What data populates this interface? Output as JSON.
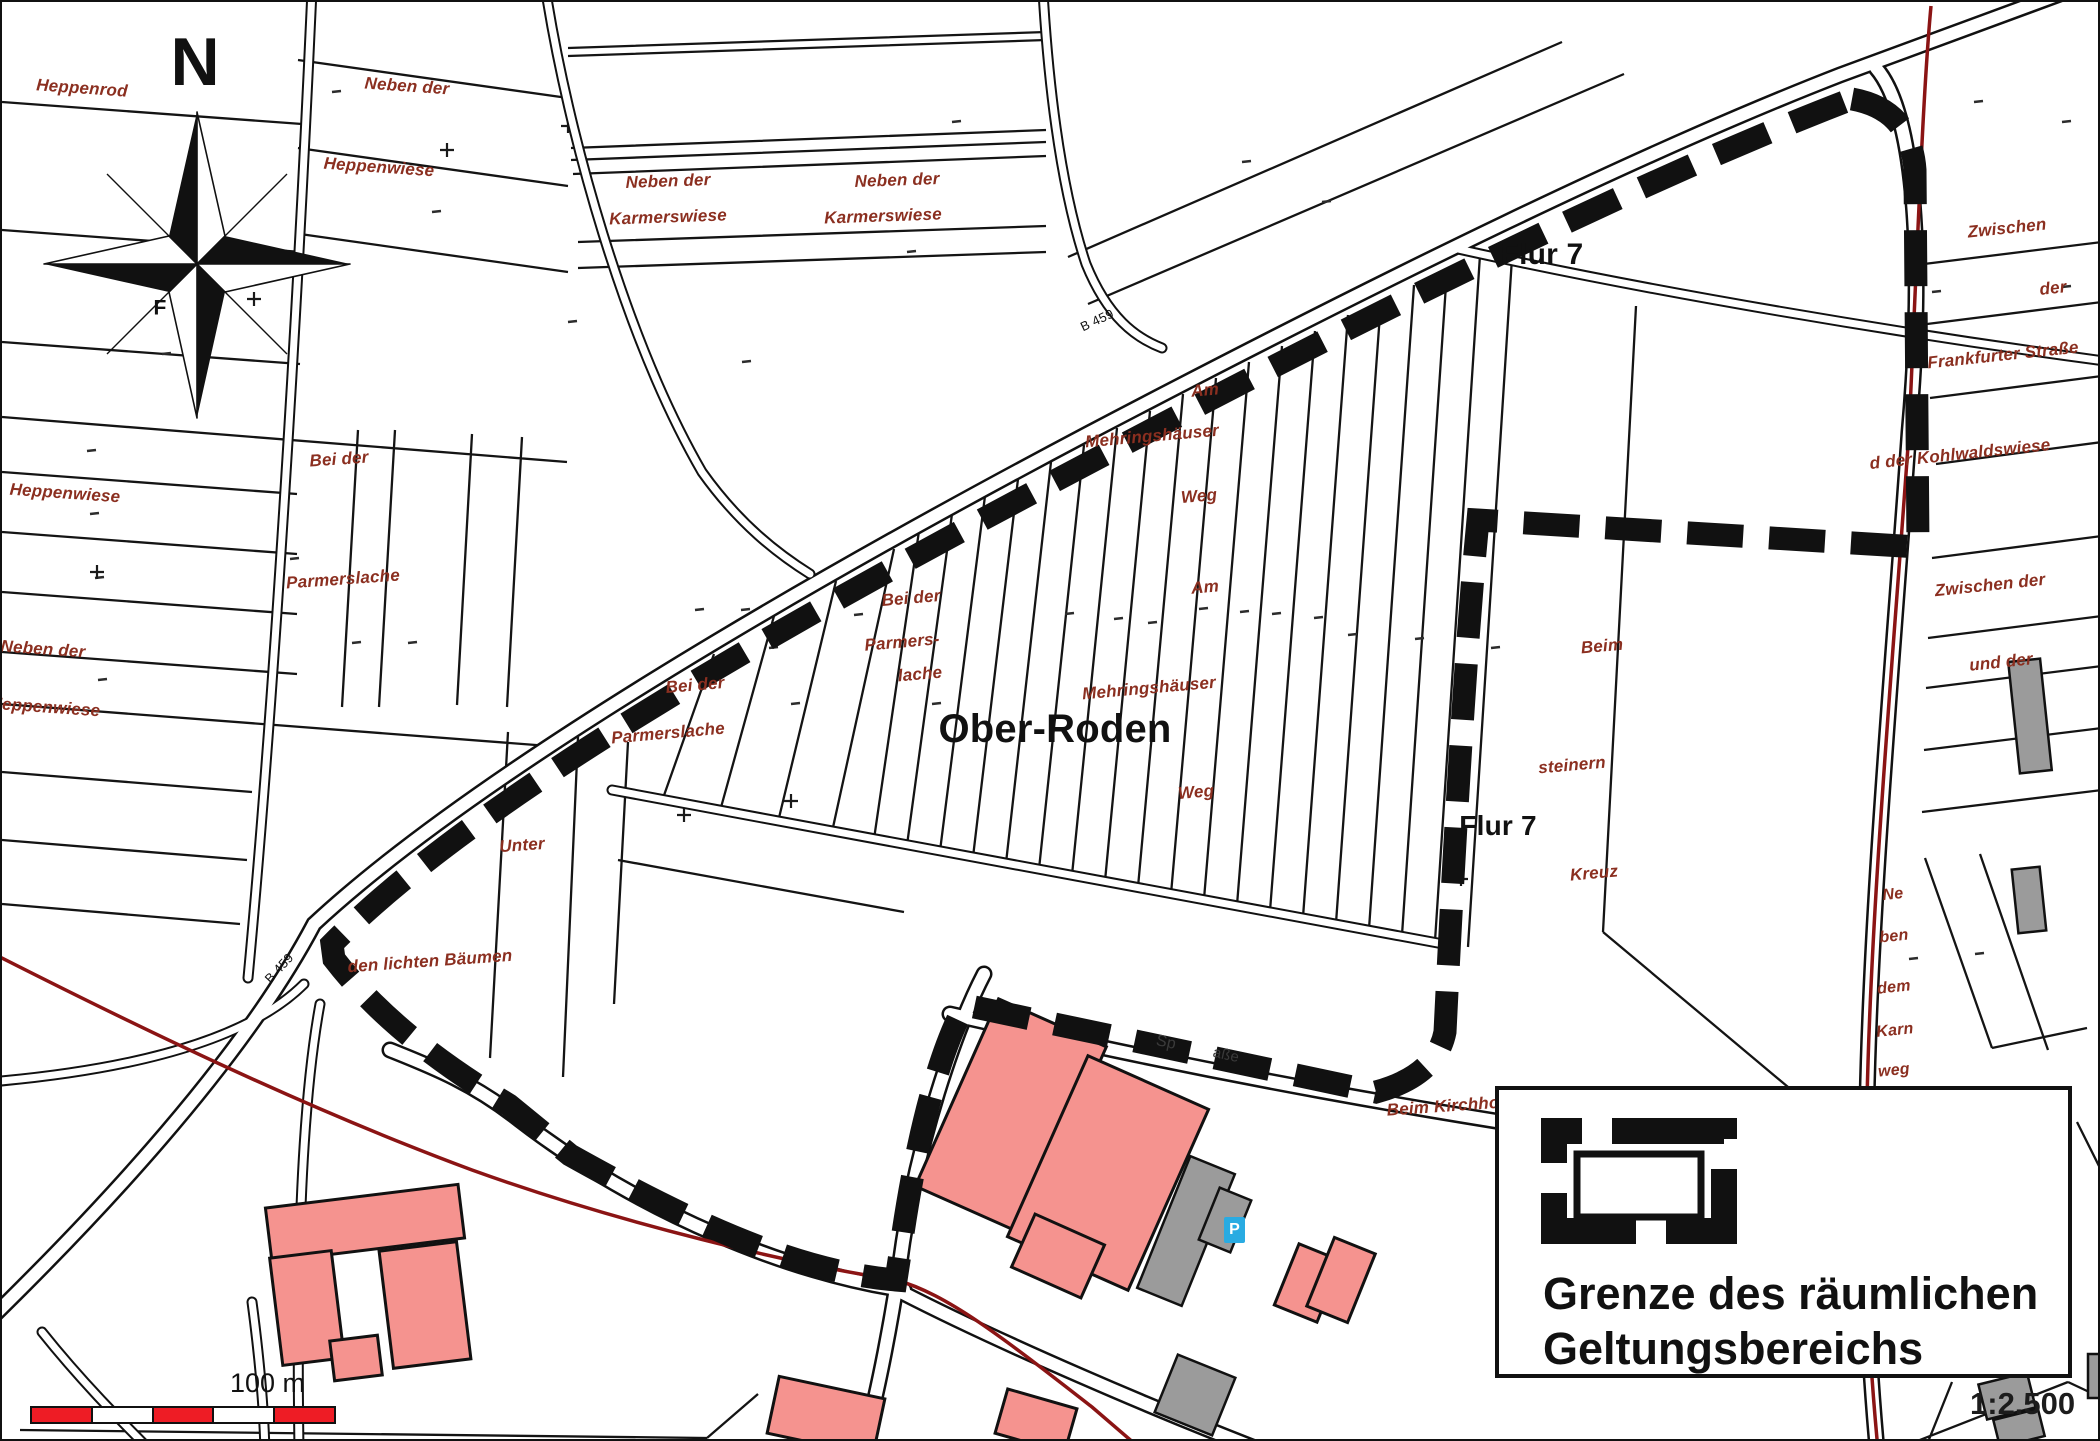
{
  "map": {
    "colors": {
      "field": "#8B2F20",
      "ink": "#111111",
      "ink2": "#3a3a3a",
      "building_pink": "#F5938F",
      "building_gray": "#9B9B9B",
      "parking_blue": "#29ABE2",
      "boundary_black": "#111111",
      "red_line": "#8B1414",
      "scalebar_red": "#EE1C25"
    },
    "compass": {
      "north_label": "N"
    },
    "legend": {
      "line1": "Grenze des räumlichen",
      "line2": "Geltungsbereichs"
    },
    "scale_bar": {
      "label": "100 m",
      "segments": [
        "#EE1C25",
        "#FFFFFF",
        "#EE1C25",
        "#FFFFFF",
        "#EE1C25"
      ]
    },
    "ratio_text": "1:2.500",
    "parking_label": "P",
    "labels": [
      {
        "t": "Heppenrod",
        "x": 80,
        "y": 86,
        "r": 4,
        "fs": 17,
        "c": "field",
        "b": 1,
        "i": 1
      },
      {
        "t": "Neben der",
        "x": 405,
        "y": 84,
        "r": 4,
        "fs": 17,
        "c": "field",
        "b": 1,
        "i": 1
      },
      {
        "t": "Heppenwiese",
        "x": 377,
        "y": 165,
        "r": 4,
        "fs": 17,
        "c": "field",
        "b": 1,
        "i": 1
      },
      {
        "t": "Neben der",
        "x": 666,
        "y": 179,
        "r": -2,
        "fs": 17,
        "c": "field",
        "b": 1,
        "i": 1
      },
      {
        "t": "Karmerswiese",
        "x": 666,
        "y": 215,
        "r": -2,
        "fs": 17,
        "c": "field",
        "b": 1,
        "i": 1
      },
      {
        "t": "Neben der",
        "x": 895,
        "y": 178,
        "r": -2,
        "fs": 17,
        "c": "field",
        "b": 1,
        "i": 1
      },
      {
        "t": "Karmerswiese",
        "x": 881,
        "y": 214,
        "r": -2,
        "fs": 17,
        "c": "field",
        "b": 1,
        "i": 1
      },
      {
        "t": "Zwischen",
        "x": 2005,
        "y": 226,
        "r": -6,
        "fs": 17,
        "c": "field",
        "b": 1,
        "i": 1
      },
      {
        "t": "der",
        "x": 2051,
        "y": 286,
        "r": -6,
        "fs": 17,
        "c": "field",
        "b": 1,
        "i": 1
      },
      {
        "t": "Frankfurter Straße",
        "x": 2001,
        "y": 353,
        "r": -6,
        "fs": 17,
        "c": "field",
        "b": 1,
        "i": 1
      },
      {
        "t": "d der Kohlwaldswiese",
        "x": 1958,
        "y": 452,
        "r": -6,
        "fs": 17,
        "c": "field",
        "b": 1,
        "i": 1
      },
      {
        "t": "Zwischen der",
        "x": 1988,
        "y": 583,
        "r": -6,
        "fs": 17,
        "c": "field",
        "b": 1,
        "i": 1
      },
      {
        "t": "und der",
        "x": 1999,
        "y": 660,
        "r": -6,
        "fs": 17,
        "c": "field",
        "b": 1,
        "i": 1
      },
      {
        "t": "Ne",
        "x": 1891,
        "y": 893,
        "r": -6,
        "fs": 16,
        "c": "field",
        "b": 1,
        "i": 1
      },
      {
        "t": "ben",
        "x": 1892,
        "y": 935,
        "r": -6,
        "fs": 16,
        "c": "field",
        "b": 1,
        "i": 1
      },
      {
        "t": "dem",
        "x": 1892,
        "y": 986,
        "r": -6,
        "fs": 16,
        "c": "field",
        "b": 1,
        "i": 1
      },
      {
        "t": "Karn",
        "x": 1893,
        "y": 1029,
        "r": -6,
        "fs": 16,
        "c": "field",
        "b": 1,
        "i": 1
      },
      {
        "t": "weg",
        "x": 1892,
        "y": 1069,
        "r": -6,
        "fs": 16,
        "c": "field",
        "b": 1,
        "i": 1
      },
      {
        "t": "Heppenwiese",
        "x": 63,
        "y": 491,
        "r": 4,
        "fs": 17,
        "c": "field",
        "b": 1,
        "i": 1
      },
      {
        "t": "Bei der",
        "x": 337,
        "y": 457,
        "r": -4,
        "fs": 17,
        "c": "field",
        "b": 1,
        "i": 1
      },
      {
        "t": "Parmerslache",
        "x": 341,
        "y": 577,
        "r": -4,
        "fs": 17,
        "c": "field",
        "b": 1,
        "i": 1
      },
      {
        "t": "Neben der",
        "x": 41,
        "y": 647,
        "r": 4,
        "fs": 17,
        "c": "field",
        "b": 1,
        "i": 1
      },
      {
        "t": "Heppenwiese",
        "x": 43,
        "y": 705,
        "r": 4,
        "fs": 17,
        "c": "field",
        "b": 1,
        "i": 1
      },
      {
        "t": "Bei der",
        "x": 909,
        "y": 596,
        "r": -5,
        "fs": 17,
        "c": "field",
        "b": 1,
        "i": 1
      },
      {
        "t": "Parmers-",
        "x": 900,
        "y": 640,
        "r": -5,
        "fs": 17,
        "c": "field",
        "b": 1,
        "i": 1
      },
      {
        "t": "lache",
        "x": 918,
        "y": 672,
        "r": -5,
        "fs": 17,
        "c": "field",
        "b": 1,
        "i": 1
      },
      {
        "t": "Bei der",
        "x": 693,
        "y": 683,
        "r": -5,
        "fs": 17,
        "c": "field",
        "b": 1,
        "i": 1
      },
      {
        "t": "Parmerslache",
        "x": 666,
        "y": 731,
        "r": -5,
        "fs": 17,
        "c": "field",
        "b": 1,
        "i": 1
      },
      {
        "t": "Am",
        "x": 1203,
        "y": 388,
        "r": -5,
        "fs": 17,
        "c": "field",
        "b": 1,
        "i": 1
      },
      {
        "t": "Mehringshäuser",
        "x": 1150,
        "y": 434,
        "r": -5,
        "fs": 17,
        "c": "field",
        "b": 1,
        "i": 1
      },
      {
        "t": "Weg",
        "x": 1197,
        "y": 494,
        "r": -5,
        "fs": 17,
        "c": "field",
        "b": 1,
        "i": 1
      },
      {
        "t": "Am",
        "x": 1203,
        "y": 585,
        "r": -5,
        "fs": 17,
        "c": "field",
        "b": 1,
        "i": 1
      },
      {
        "t": "Mehringshäuser",
        "x": 1147,
        "y": 686,
        "r": -5,
        "fs": 17,
        "c": "field",
        "b": 1,
        "i": 1
      },
      {
        "t": "Weg",
        "x": 1194,
        "y": 790,
        "r": -5,
        "fs": 17,
        "c": "field",
        "b": 1,
        "i": 1
      },
      {
        "t": "Unter",
        "x": 520,
        "y": 843,
        "r": -4,
        "fs": 17,
        "c": "field",
        "b": 1,
        "i": 1
      },
      {
        "t": "den lichten Bäumen",
        "x": 428,
        "y": 959,
        "r": -4,
        "fs": 17,
        "c": "field",
        "b": 1,
        "i": 1
      },
      {
        "t": "Beim",
        "x": 1600,
        "y": 644,
        "r": -5,
        "fs": 17,
        "c": "field",
        "b": 1,
        "i": 1
      },
      {
        "t": "steinern",
        "x": 1570,
        "y": 763,
        "r": -5,
        "fs": 17,
        "c": "field",
        "b": 1,
        "i": 1
      },
      {
        "t": "Kreuz",
        "x": 1592,
        "y": 871,
        "r": -5,
        "fs": 17,
        "c": "field",
        "b": 1,
        "i": 1
      },
      {
        "t": "Beim Kirchhof",
        "x": 1444,
        "y": 1104,
        "r": -4,
        "fs": 17,
        "c": "field",
        "b": 1,
        "i": 1
      },
      {
        "t": "Flur 7",
        "x": 1540,
        "y": 253,
        "r": 0,
        "fs": 30,
        "c": "ink",
        "b": 1,
        "n": "flur-label-top"
      },
      {
        "t": "Flur 7",
        "x": 1496,
        "y": 824,
        "r": 0,
        "fs": 28,
        "c": "ink",
        "b": 1,
        "n": "flur-label-mid"
      },
      {
        "t": "Ober-Roden",
        "x": 1053,
        "y": 727,
        "r": 0,
        "fs": 40,
        "c": "ink",
        "b": 1,
        "n": "place-name"
      },
      {
        "t": "B 459",
        "x": 1095,
        "y": 318,
        "r": -25,
        "fs": 13,
        "c": "ink",
        "n": "road-number"
      },
      {
        "t": "B 459",
        "x": 277,
        "y": 966,
        "r": -47,
        "fs": 13,
        "c": "ink",
        "n": "road-number"
      },
      {
        "t": "F",
        "x": 158,
        "y": 306,
        "r": 0,
        "fs": 21,
        "c": "ink",
        "b": 1
      },
      {
        "t": "Sp",
        "x": 1164,
        "y": 1041,
        "r": 12,
        "fs": 16,
        "c": "ink2",
        "n": "street-name-fragment"
      },
      {
        "t": "aße",
        "x": 1224,
        "y": 1053,
        "r": 12,
        "fs": 15,
        "c": "ink2",
        "n": "street-name-fragment"
      }
    ]
  }
}
